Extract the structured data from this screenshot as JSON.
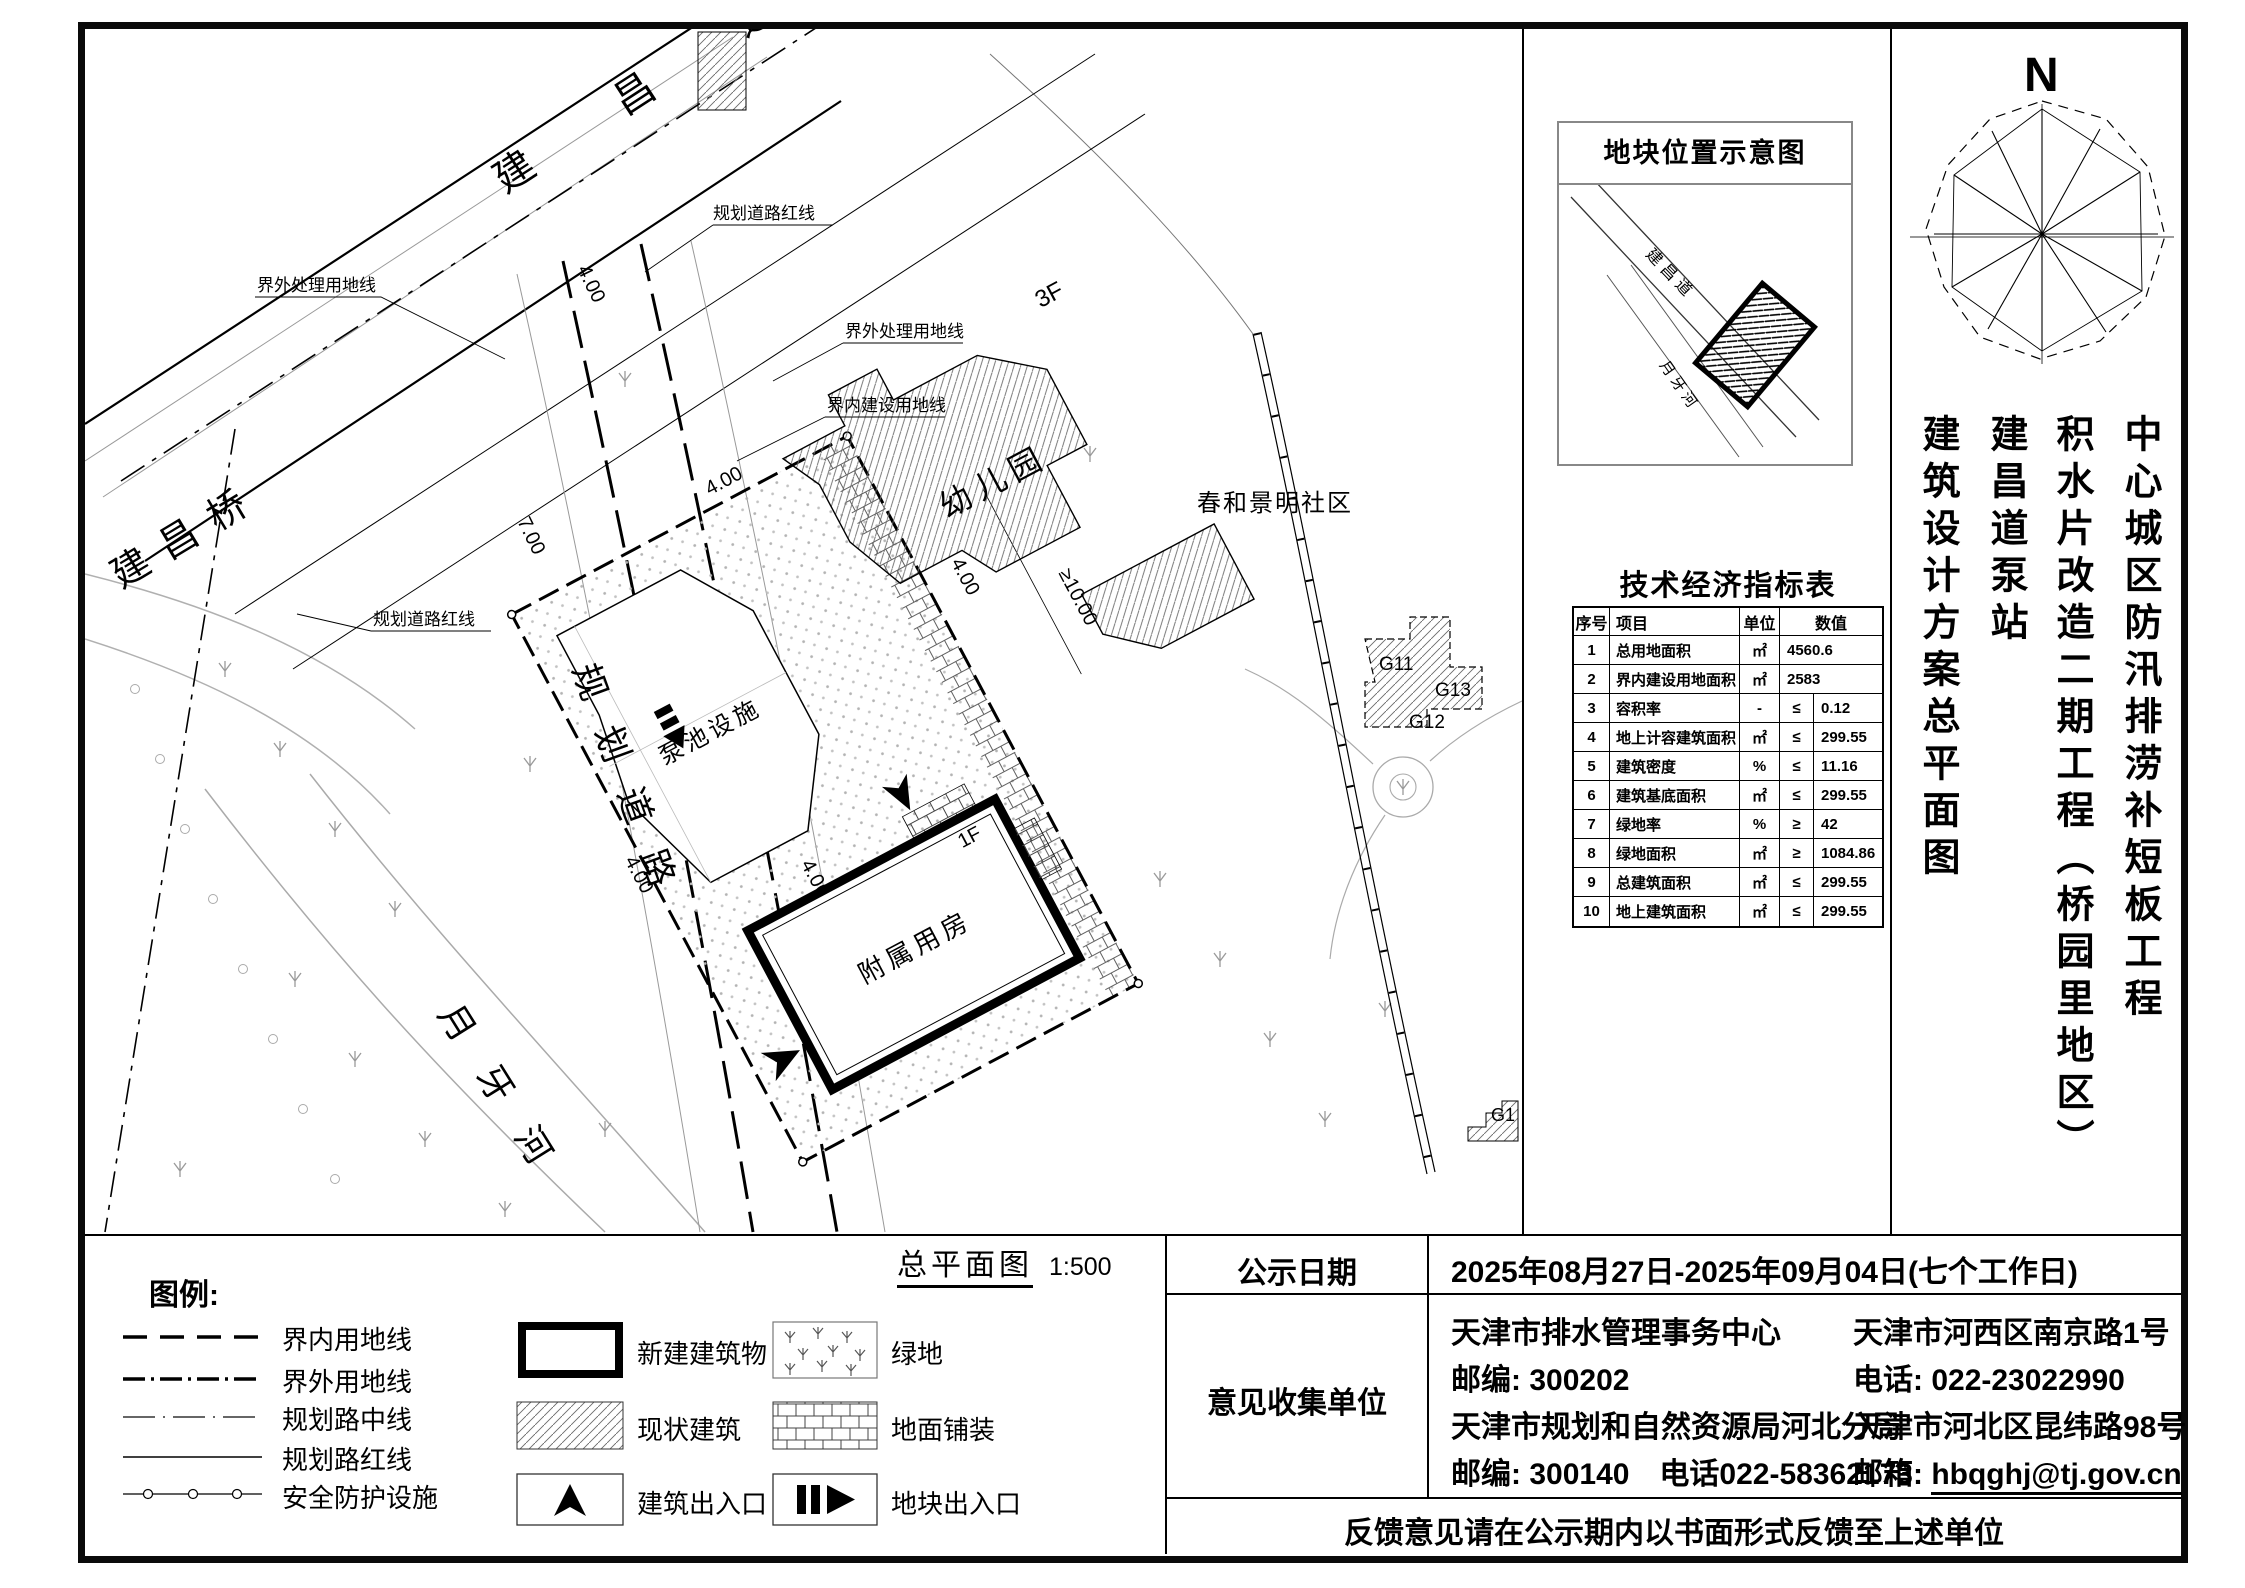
{
  "north": "N",
  "scale": {
    "label": "总平面图",
    "value": "1:500"
  },
  "location_map": {
    "title": "地块位置示意图",
    "road": "建昌道",
    "river": "月牙河"
  },
  "tech_table": {
    "title": "技术经济指标表",
    "headers": {
      "no": "序号",
      "item": "项目",
      "unit": "单位",
      "value": "数值"
    },
    "rows": [
      {
        "no": "1",
        "item": "总用地面积",
        "unit": "㎡",
        "cmp": "",
        "value": "4560.6"
      },
      {
        "no": "2",
        "item": "界内建设用地面积",
        "unit": "㎡",
        "cmp": "",
        "value": "2583"
      },
      {
        "no": "3",
        "item": "容积率",
        "unit": "-",
        "cmp": "≤",
        "value": "0.12"
      },
      {
        "no": "4",
        "item": "地上计容建筑面积",
        "unit": "㎡",
        "cmp": "≤",
        "value": "299.55"
      },
      {
        "no": "5",
        "item": "建筑密度",
        "unit": "%",
        "cmp": "≤",
        "value": "11.16"
      },
      {
        "no": "6",
        "item": "建筑基底面积",
        "unit": "㎡",
        "cmp": "≤",
        "value": "299.55"
      },
      {
        "no": "7",
        "item": "绿地率",
        "unit": "%",
        "cmp": "≥",
        "value": "42"
      },
      {
        "no": "8",
        "item": "绿地面积",
        "unit": "㎡",
        "cmp": "≥",
        "value": "1084.86"
      },
      {
        "no": "9",
        "item": "总建筑面积",
        "unit": "㎡",
        "cmp": "≤",
        "value": "299.55"
      },
      {
        "no": "10",
        "item": "地上建筑面积",
        "unit": "㎡",
        "cmp": "≤",
        "value": "299.55"
      }
    ]
  },
  "project_title": {
    "col1": "中心城区防汛排涝补短板工程",
    "col2": "积水片改造二期工程（桥园里地区）",
    "col3": "建昌道泵站",
    "col4": "建筑设计方案总平面图"
  },
  "plan": {
    "road_top": "建 昌 道",
    "bridge": "建昌桥",
    "planned_road": "规划道路",
    "river": "月牙河",
    "kindergarten": "幼儿园",
    "kindergarten_floor": "3F",
    "community": "春和景明社区",
    "pump_facility": "泵池设施",
    "aux_building": "附属用房",
    "aux_floor": "1F",
    "g11": "G11",
    "g12": "G12",
    "g13": "G13",
    "g1": "G1",
    "ann_outer": "界外处理用地线",
    "ann_redline": "规划道路红线",
    "ann_inner": "界内建设用地线",
    "dim_4": "4.00",
    "dim_7": "7.00",
    "dim_10": "≥10.00"
  },
  "legend": {
    "title": "图例:",
    "lines": [
      "界内用地线",
      "界外用地线",
      "规划路中线",
      "规划路红线",
      "安全防护设施"
    ],
    "swatches": [
      "新建建筑物",
      "现状建筑",
      "建筑出入口",
      "绿地",
      "地面铺装",
      "地块出入口"
    ]
  },
  "info": {
    "publicity_label": "公示日期",
    "publicity_value": "2025年08月27日-2025年09月04日(七个工作日)",
    "collector_label": "意见收集单位",
    "left_lines": [
      "天津市排水管理事务中心",
      "邮编: 300202",
      "天津市规划和自然资源局河北分局",
      "邮编: 300140　电话022-58362173"
    ],
    "right_lines": [
      "天津市河西区南京路1号",
      "电话: 022-23022990",
      "天津市河北区昆纬路98号"
    ],
    "email_prefix": "邮箱: ",
    "email": "hbqghj@tj.gov.cn",
    "feedback": "反馈意见请在公示期内以书面形式反馈至上述单位"
  }
}
